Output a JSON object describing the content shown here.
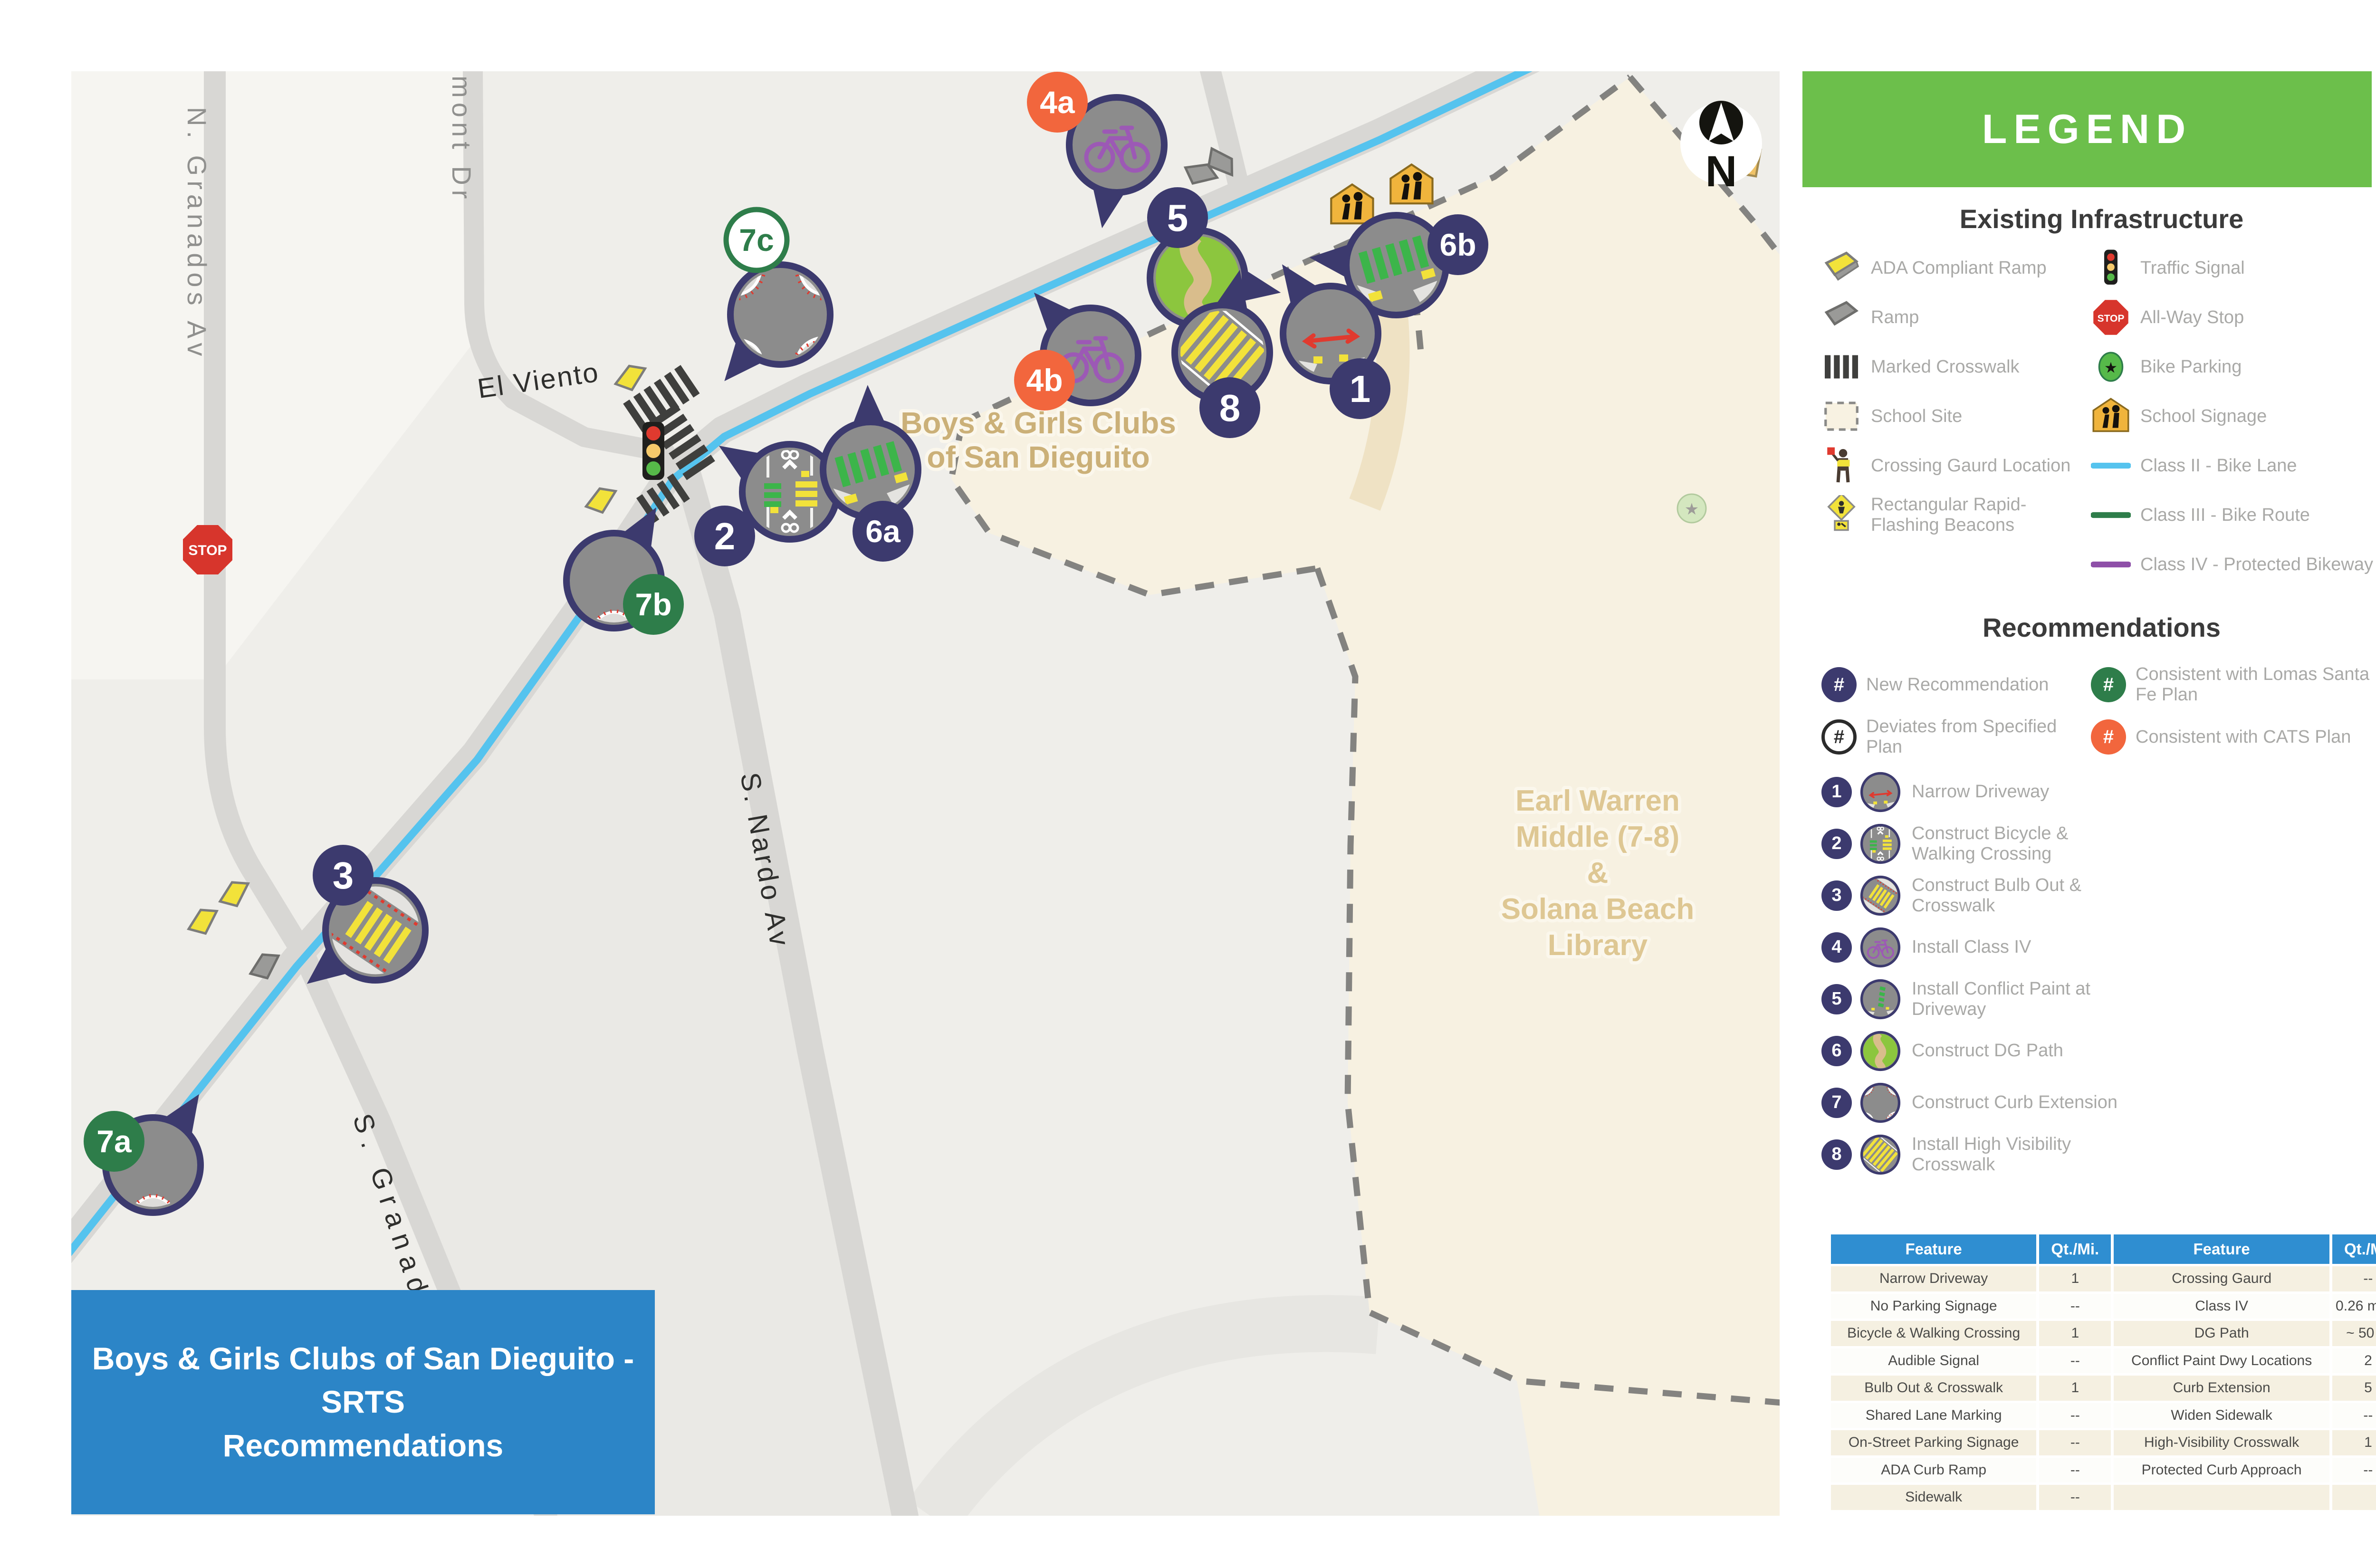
{
  "title_box": {
    "line1": "Boys & Girls Clubs of San Dieguito - SRTS",
    "line2": "Recommendations"
  },
  "map": {
    "street_labels": {
      "n_granados": "N. Granados Av",
      "partial_street": "nmont Dr",
      "el_viento": "El Viento",
      "s_nardo": "S. Nardo Av",
      "s_granados": "S. Granados"
    },
    "site_labels": {
      "bgc_line1": "Boys & Girls Clubs",
      "bgc_line2": "of San Dieguito",
      "school_line1": "Earl Warren",
      "school_line2": "Middle (7-8)",
      "school_line3": "&",
      "school_line4": "Solana Beach",
      "school_line5": "Library"
    },
    "stop_sign_text": "STOP",
    "north_label": "N",
    "markers": [
      {
        "label": "4a",
        "kind": "orange",
        "badge": [
          2225,
          215
        ],
        "bubble": [
          2350,
          305
        ],
        "r": 100,
        "tail": 100,
        "content": "bike"
      },
      {
        "label": "5",
        "kind": "navy",
        "badge": [
          2478,
          458
        ],
        "bubble": [
          2520,
          585
        ],
        "r": 100,
        "tail": 10,
        "content": "dg"
      },
      {
        "label": "6b",
        "kind": "navy",
        "badge": [
          3068,
          515
        ],
        "bubble": [
          2938,
          558
        ],
        "r": 105,
        "tail": 185,
        "content": "greencross"
      },
      {
        "label": "1",
        "kind": "navy",
        "badge": [
          2862,
          818
        ],
        "bubble": [
          2800,
          702
        ],
        "r": 100,
        "tail": 235,
        "content": "narrow"
      },
      {
        "label": "8",
        "kind": "navy",
        "badge": [
          2588,
          858
        ],
        "bubble": [
          2572,
          742
        ],
        "r": 100,
        "tail": 282,
        "content": "highvis"
      },
      {
        "label": "4b",
        "kind": "orange",
        "badge": [
          2198,
          800
        ],
        "bubble": [
          2295,
          748
        ],
        "r": 100,
        "tail": 228,
        "content": "bike"
      },
      {
        "label": "7c",
        "kind": "green-outline",
        "badge": [
          1592,
          505
        ],
        "bubble": [
          1642,
          662
        ],
        "r": 105,
        "tail": 130,
        "content": "curb4"
      },
      {
        "label": "2",
        "kind": "navy",
        "badge": [
          1525,
          1128
        ],
        "bubble": [
          1662,
          1035
        ],
        "r": 100,
        "tail": 213,
        "content": "bikewalk"
      },
      {
        "label": "6a",
        "kind": "navy",
        "badge": [
          1858,
          1118
        ],
        "bubble": [
          1832,
          988
        ],
        "r": 100,
        "tail": 268,
        "content": "greencross"
      },
      {
        "label": "7b",
        "kind": "green",
        "badge": [
          1375,
          1272
        ],
        "bubble": [
          1292,
          1222
        ],
        "r": 100,
        "tail": 300,
        "content": "curb1"
      },
      {
        "label": "3",
        "kind": "navy",
        "badge": [
          722,
          1842
        ],
        "bubble": [
          790,
          1958
        ],
        "r": 105,
        "tail": 142,
        "content": "bulbout"
      },
      {
        "label": "7a",
        "kind": "green",
        "badge": [
          240,
          2402
        ],
        "bubble": [
          322,
          2452
        ],
        "r": 100,
        "tail": 303,
        "content": "curb1"
      }
    ]
  },
  "legend": {
    "header": "LEGEND",
    "existing_title": "Existing Infrastructure",
    "existing_left": [
      {
        "icon": "ada-ramp",
        "label": "ADA Compliant Ramp"
      },
      {
        "icon": "ramp",
        "label": "Ramp"
      },
      {
        "icon": "marked-crosswalk",
        "label": "Marked Crosswalk"
      },
      {
        "icon": "school-site",
        "label": "School Site"
      },
      {
        "icon": "crossing-guard",
        "label": "Crossing Gaurd Location"
      },
      {
        "icon": "rrfb",
        "label": "Rectangular Rapid-Flashing Beacons"
      }
    ],
    "existing_right": [
      {
        "icon": "traffic-signal",
        "label": "Traffic Signal"
      },
      {
        "icon": "all-way-stop",
        "label": "All-Way Stop"
      },
      {
        "icon": "bike-parking",
        "label": "Bike Parking"
      },
      {
        "icon": "school-signage",
        "label": "School Signage"
      },
      {
        "icon": "class-ii",
        "label": "Class II - Bike Lane"
      },
      {
        "icon": "class-iii",
        "label": "Class III - Bike Route"
      },
      {
        "icon": "class-iv",
        "label": "Class IV - Protected Bikeway"
      }
    ],
    "rec_title": "Recommendations",
    "rec_badges": [
      {
        "style": "navy",
        "symbol": "#",
        "label": "New Recommendation"
      },
      {
        "style": "green",
        "symbol": "#",
        "label": "Consistent with Lomas Santa Fe Plan"
      },
      {
        "style": "outline",
        "symbol": "#",
        "label": "Deviates from Specified Plan"
      },
      {
        "style": "orange",
        "symbol": "#",
        "label": "Consistent with CATS Plan"
      }
    ],
    "rec_items": [
      {
        "num": "1",
        "content": "narrow",
        "label": "Narrow Driveway"
      },
      {
        "num": "2",
        "content": "bikewalk",
        "label": "Construct Bicycle & Walking Crossing"
      },
      {
        "num": "3",
        "content": "bulbout",
        "label": "Construct Bulb Out & Crosswalk"
      },
      {
        "num": "4",
        "content": "bike",
        "label": "Install Class IV"
      },
      {
        "num": "5",
        "content": "conflict",
        "label": "Install Conflict Paint at Driveway"
      },
      {
        "num": "6",
        "content": "dg",
        "label": "Construct DG Path"
      },
      {
        "num": "7",
        "content": "curb4",
        "label": "Construct Curb Extension"
      },
      {
        "num": "8",
        "content": "highvis",
        "label": "Install High Visibility Crosswalk"
      }
    ]
  },
  "table": {
    "headers": [
      "Feature",
      "Qt./Mi.",
      "Feature",
      "Qt./Mi."
    ],
    "rows": [
      [
        "Narrow Driveway",
        "1",
        "Crossing Gaurd",
        "--"
      ],
      [
        "No Parking Signage",
        "--",
        "Class IV",
        "0.26 miles"
      ],
      [
        "Bicycle & Walking Crossing",
        "1",
        "DG Path",
        "~ 50 ft."
      ],
      [
        "Audible Signal",
        "--",
        "Conflict Paint Dwy Locations",
        "2"
      ],
      [
        "Bulb Out & Crosswalk",
        "1",
        "Curb Extension",
        "5"
      ],
      [
        "Shared Lane Marking",
        "--",
        "Widen Sidewalk",
        "--"
      ],
      [
        "On-Street Parking Signage",
        "--",
        "High-Visibility Crosswalk",
        "1"
      ],
      [
        "ADA Curb Ramp",
        "--",
        "Protected Curb Approach",
        "--"
      ],
      [
        "Sidewalk",
        "--",
        "",
        ""
      ]
    ]
  },
  "colors": {
    "navy": "#3C3A6E",
    "green": "#2E7D4A",
    "orange": "#F2663D",
    "legend_green": "#6CBF4B",
    "table_blue": "#2F8ED1",
    "title_blue": "#2C85C7",
    "class_ii_blue": "#55C3EE",
    "class_iv_purple": "#8E4FA8"
  }
}
